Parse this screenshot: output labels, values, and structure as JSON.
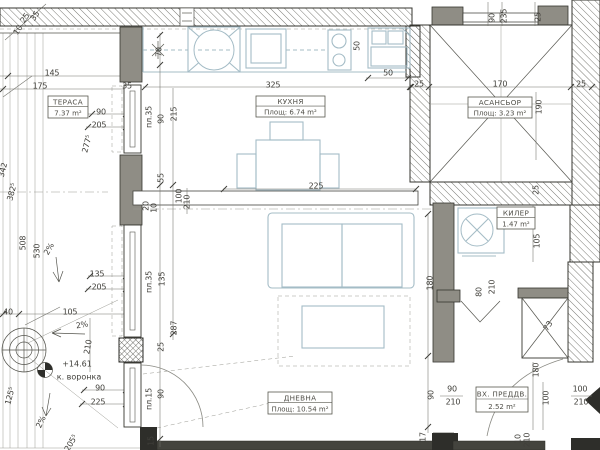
{
  "rooms": [
    {
      "id": "terrace",
      "name": "ТЕРАСА",
      "area": "7.37 m²",
      "x": 48,
      "y": 96,
      "w": 40,
      "h": 22
    },
    {
      "id": "kitchen",
      "name": "КУХНЯ",
      "area": "Площ: 6.74 m²",
      "x": 256,
      "y": 96,
      "w": 69,
      "h": 21
    },
    {
      "id": "elevator",
      "name": "АСАНСЬОР",
      "area": "Площ: 3.23 m²",
      "x": 468,
      "y": 97,
      "w": 64,
      "h": 21
    },
    {
      "id": "storage",
      "name": "КИЛЕР",
      "area": "1.47 m²",
      "x": 497,
      "y": 207,
      "w": 38,
      "h": 22
    },
    {
      "id": "living-room",
      "name": "ДНЕВНА",
      "area": "Площ: 10.54 m²",
      "x": 268,
      "y": 392,
      "w": 64,
      "h": 22
    },
    {
      "id": "entrance-hall",
      "name": "ВХ. ПРЕДДВ.",
      "area": "2.52 m²",
      "x": 476,
      "y": 387,
      "w": 52,
      "h": 25
    }
  ],
  "annotations": [
    {
      "t": "+14.61",
      "x": 77,
      "y": 364
    },
    {
      "t": "к. воронка",
      "x": 79,
      "y": 377
    }
  ],
  "dimension_labels": [
    {
      "t": "10",
      "x": 18,
      "y": 30,
      "r": -55
    },
    {
      "t": "25",
      "x": 25,
      "y": 18,
      "r": -55
    },
    {
      "t": "35",
      "x": 35,
      "y": 16,
      "r": -55
    },
    {
      "t": "145",
      "x": 52,
      "y": 73,
      "r": 0
    },
    {
      "t": "175",
      "x": 40,
      "y": 86,
      "r": 0
    },
    {
      "t": "35",
      "x": 127,
      "y": 86,
      "r": 0
    },
    {
      "t": "90",
      "x": 101,
      "y": 112,
      "r": 0
    },
    {
      "t": "205",
      "x": 99,
      "y": 125,
      "r": 0
    },
    {
      "t": "277⁵",
      "x": 87,
      "y": 144,
      "r": -75
    },
    {
      "t": "342",
      "x": 3,
      "y": 170,
      "r": -75
    },
    {
      "t": "382⁵",
      "x": 12,
      "y": 192,
      "r": -75
    },
    {
      "t": "508",
      "x": 23,
      "y": 243,
      "r": -90
    },
    {
      "t": "530",
      "x": 37,
      "y": 251,
      "r": -90
    },
    {
      "t": "2%",
      "x": 49,
      "y": 249,
      "r": -60
    },
    {
      "t": "135",
      "x": 97,
      "y": 274,
      "r": 0
    },
    {
      "t": "205",
      "x": 99,
      "y": 287,
      "r": 0
    },
    {
      "t": "105",
      "x": 70,
      "y": 312,
      "r": 0
    },
    {
      "t": "40",
      "x": 8,
      "y": 312,
      "r": 0
    },
    {
      "t": "2%",
      "x": 82,
      "y": 325,
      "r": -10
    },
    {
      "t": "210",
      "x": 88,
      "y": 347,
      "r": -80
    },
    {
      "t": "125⁵",
      "x": 10,
      "y": 396,
      "r": -75
    },
    {
      "t": "2%",
      "x": 41,
      "y": 422,
      "r": -65
    },
    {
      "t": "205⁵",
      "x": 71,
      "y": 443,
      "r": -60
    },
    {
      "t": "70",
      "x": 159,
      "y": 52,
      "r": -90
    },
    {
      "t": "пл.35",
      "x": 149,
      "y": 117,
      "r": -90
    },
    {
      "t": "90",
      "x": 161,
      "y": 119,
      "r": -90
    },
    {
      "t": "215",
      "x": 174,
      "y": 114,
      "r": -90
    },
    {
      "t": "55",
      "x": 161,
      "y": 178,
      "r": -90
    },
    {
      "t": "20",
      "x": 146,
      "y": 206,
      "r": -90
    },
    {
      "t": "10",
      "x": 154,
      "y": 208,
      "r": -90
    },
    {
      "t": "100",
      "x": 179,
      "y": 196,
      "r": -90
    },
    {
      "t": "210",
      "x": 187,
      "y": 202,
      "r": -90
    },
    {
      "t": "пл.35",
      "x": 149,
      "y": 282,
      "r": -90
    },
    {
      "t": "135",
      "x": 162,
      "y": 279,
      "r": -90
    },
    {
      "t": "287",
      "x": 174,
      "y": 328,
      "r": -90
    },
    {
      "t": "25",
      "x": 161,
      "y": 347,
      "r": -90
    },
    {
      "t": "пл.15",
      "x": 149,
      "y": 399,
      "r": -90
    },
    {
      "t": "90",
      "x": 161,
      "y": 394,
      "r": -90
    },
    {
      "t": "15",
      "x": 151,
      "y": 441,
      "r": -90
    },
    {
      "t": "90",
      "x": 100,
      "y": 388,
      "r": 0
    },
    {
      "t": "225",
      "x": 98,
      "y": 402,
      "r": 0
    },
    {
      "t": "50",
      "x": 357,
      "y": 46,
      "r": -90
    },
    {
      "t": "50",
      "x": 388,
      "y": 73,
      "r": 0
    },
    {
      "t": "325",
      "x": 273,
      "y": 85,
      "r": 0
    },
    {
      "t": "225",
      "x": 316,
      "y": 186,
      "r": 0
    },
    {
      "t": "90",
      "x": 492,
      "y": 18,
      "r": -90
    },
    {
      "t": "235",
      "x": 504,
      "y": 16,
      "r": -90
    },
    {
      "t": "25",
      "x": 538,
      "y": 17,
      "r": -90
    },
    {
      "t": "25",
      "x": 419,
      "y": 84,
      "r": 0
    },
    {
      "t": "170",
      "x": 500,
      "y": 84,
      "r": 0
    },
    {
      "t": "25",
      "x": 581,
      "y": 84,
      "r": 0
    },
    {
      "t": "190",
      "x": 539,
      "y": 107,
      "r": -90
    },
    {
      "t": "25",
      "x": 536,
      "y": 190,
      "r": -90
    },
    {
      "t": "105",
      "x": 537,
      "y": 241,
      "r": -90
    },
    {
      "t": "80",
      "x": 479,
      "y": 292,
      "r": -90
    },
    {
      "t": "210",
      "x": 492,
      "y": 287,
      "r": -90
    },
    {
      "t": "73",
      "x": 548,
      "y": 326,
      "r": -55
    },
    {
      "t": "180",
      "x": 430,
      "y": 283,
      "r": -90
    },
    {
      "t": "180",
      "x": 536,
      "y": 370,
      "r": -90
    },
    {
      "t": "100",
      "x": 546,
      "y": 398,
      "r": -90
    },
    {
      "t": "90",
      "x": 431,
      "y": 395,
      "r": -90
    },
    {
      "t": "90",
      "x": 452,
      "y": 389,
      "r": 0
    },
    {
      "t": "210",
      "x": 453,
      "y": 402,
      "r": 0
    },
    {
      "t": "100",
      "x": 580,
      "y": 389,
      "r": 0
    },
    {
      "t": "210",
      "x": 581,
      "y": 402,
      "r": 0
    },
    {
      "t": "17",
      "x": 423,
      "y": 437,
      "r": -90
    },
    {
      "t": "10",
      "x": 518,
      "y": 439,
      "r": -90
    },
    {
      "t": "210",
      "x": 527,
      "y": 440,
      "r": -90
    }
  ],
  "colors": {
    "wall_gray": "#8f8d85",
    "wall_dark": "#44443e",
    "hatch_line": "#6b6b64",
    "furniture_blue": "#a4bcc6",
    "text": "#403f3a"
  }
}
